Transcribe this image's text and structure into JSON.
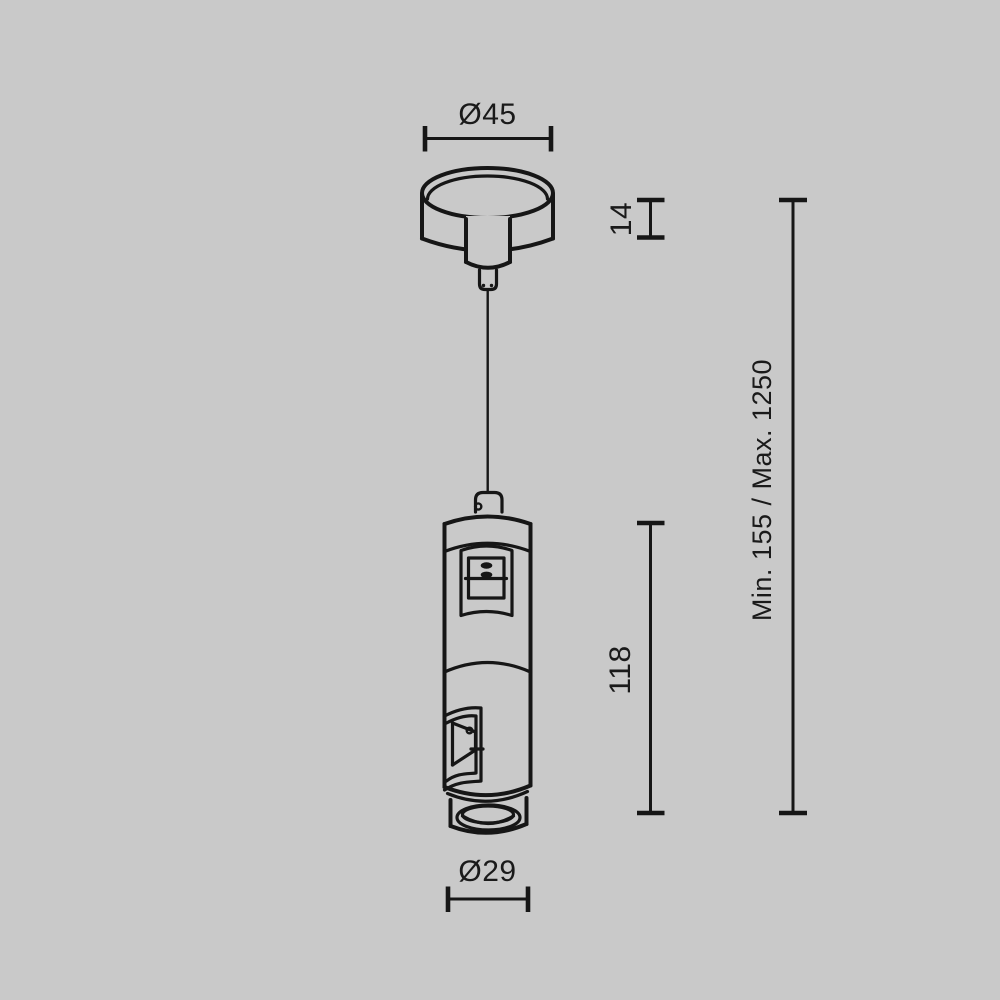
{
  "colors": {
    "background": "#c9c9c9",
    "line": "#161616",
    "text": "#1a1a1a"
  },
  "dimensions": {
    "canopy_diameter": "Ø45",
    "canopy_height": "14",
    "body_height": "118",
    "suspension_range": "Min. 155 / Max. 1250",
    "bottom_diameter": "Ø29"
  }
}
